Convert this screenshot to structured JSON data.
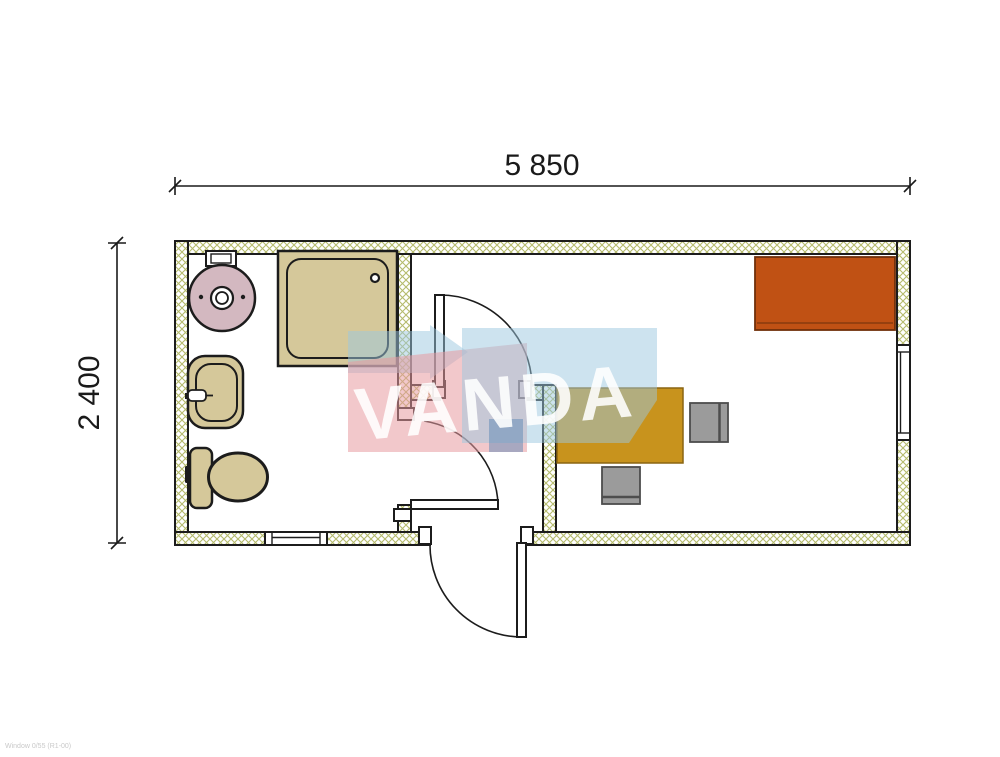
{
  "page": {
    "title": "Container office floor plan"
  },
  "dimensions": {
    "width_label": "5 850",
    "height_label": "2 400"
  },
  "watermark": {
    "text": "VANDA",
    "pink": "#e89aa0",
    "light_blue": "#9cc8e0",
    "dark_blue": "#5d88b5"
  },
  "footer": {
    "note": "Window 0/55 (R1-00)"
  },
  "plan": {
    "rooms": [
      {
        "name": "bathroom",
        "fixtures": [
          "water-heater",
          "shower-tray",
          "washbasin",
          "toilet"
        ]
      },
      {
        "name": "entry-vestibule",
        "features": [
          "entrance-door",
          "bathroom-door",
          "room-door"
        ]
      },
      {
        "name": "office",
        "furniture": [
          "desk",
          "office-chair",
          "office-chair",
          "cabinet"
        ]
      }
    ],
    "windows": [
      "right-wall-window",
      "bottom-wall-window"
    ]
  },
  "colors": {
    "line": "#1c1c1c",
    "wall_hatch": "#b5bb6c",
    "fixture_tan": "#d5c89a",
    "boiler_pink": "#d3b8c0",
    "desk_gold": "#c8931d",
    "cabinet_orange": "#c05114",
    "chair_gray": "#9b9b9b"
  }
}
